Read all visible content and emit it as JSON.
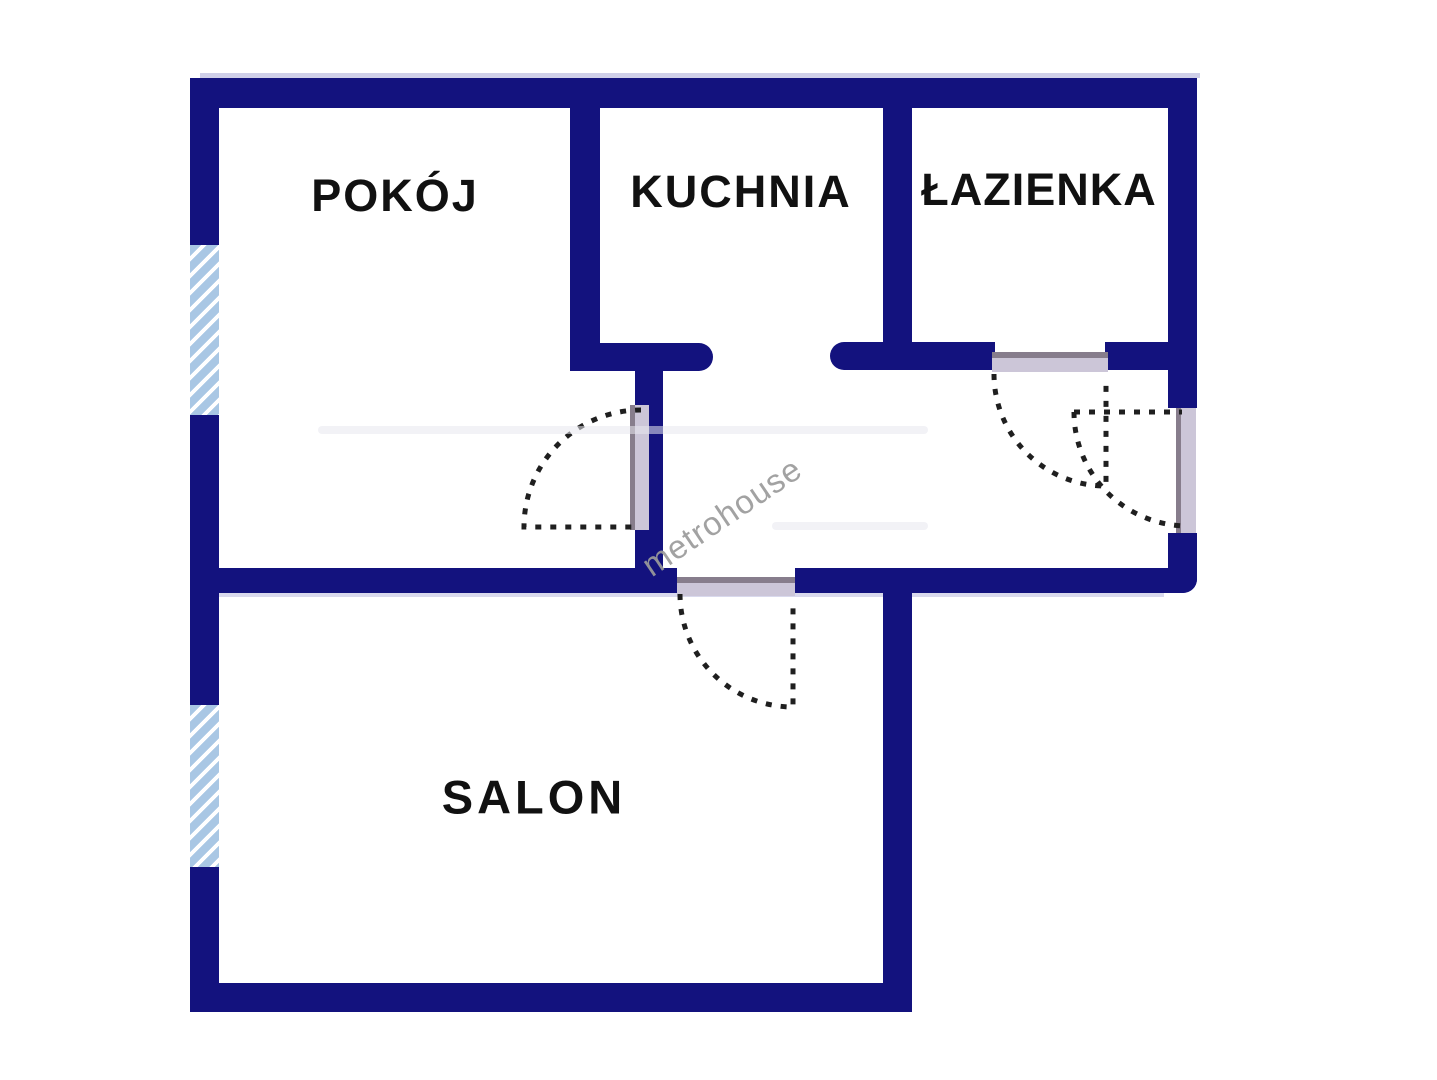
{
  "plan": {
    "watermark": "metrohouse",
    "rooms": {
      "pokoj": {
        "label": "POKÓJ"
      },
      "kuchnia": {
        "label": "KUCHNIA"
      },
      "lazienka": {
        "label": "ŁAZIENKA"
      },
      "salon": {
        "label": "SALON"
      }
    },
    "features": {
      "windows": [
        "window-pokoj-west",
        "window-salon-west"
      ],
      "doors": [
        "door-pokoj",
        "door-salon",
        "door-lazienka",
        "door-entrance"
      ]
    },
    "colors": {
      "wall": "#13127e",
      "window_fill": "#a9c7e4",
      "window_stripe": "#ffffff",
      "door_panel": "#ccc6d8",
      "door_edge": "#877d8c",
      "swing_dash": "#1f1f1f",
      "label_text": "#111111",
      "watermark_text": "#9b9b9b",
      "background": "#ffffff"
    }
  }
}
